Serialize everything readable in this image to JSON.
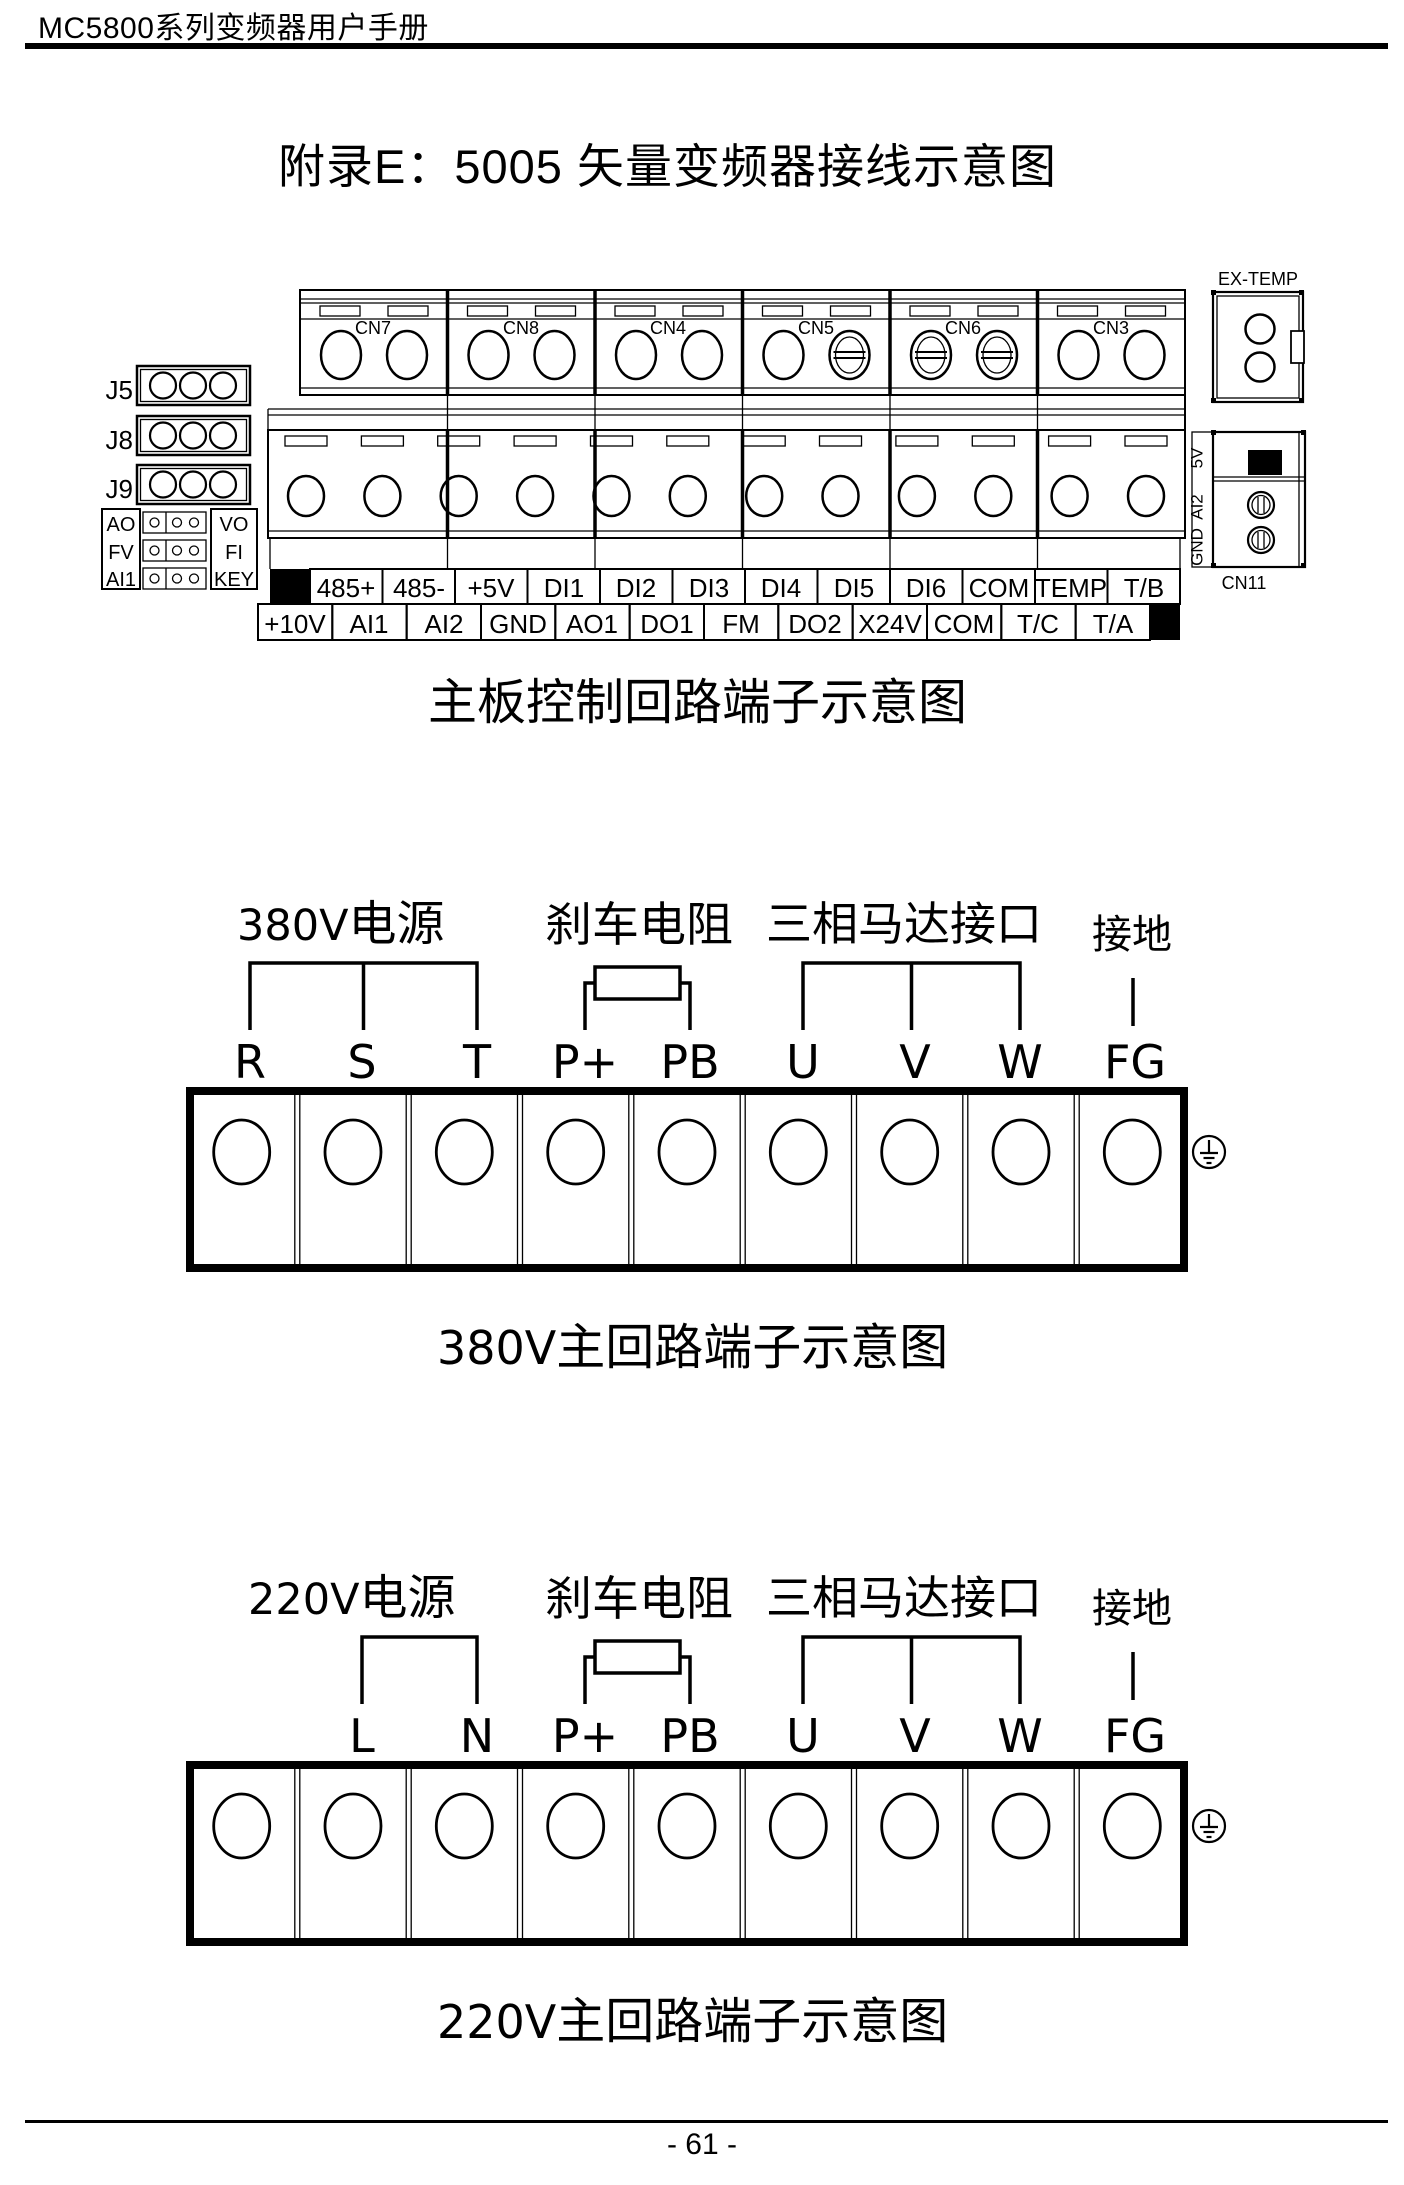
{
  "page": {
    "header": "MC5800系列变频器用户手册",
    "title": "附录E：5005 矢量变频器接线示意图",
    "footer": "- 61 -"
  },
  "board": {
    "caption": "主板控制回路端子示意图",
    "connectors": [
      "CN7",
      "CN8",
      "CN4",
      "CN5",
      "CN6",
      "CN3"
    ],
    "ex_temp": "EX-TEMP",
    "cn11": "CN11",
    "cn11_pins": [
      "5V",
      "AI2",
      "GND"
    ],
    "jumpers": [
      "J5",
      "J8",
      "J9"
    ],
    "jumper_left": [
      "AO",
      "FV",
      "AI1"
    ],
    "jumper_right": [
      "VO",
      "FI",
      "KEY"
    ],
    "row1": [
      "485+",
      "485-",
      "+5V",
      "DI1",
      "DI2",
      "DI3",
      "DI4",
      "DI5",
      "DI6",
      "COM",
      "TEMP",
      "T/B"
    ],
    "row2": [
      "+10V",
      "AI1",
      "AI2",
      "GND",
      "AO1",
      "DO1",
      "FM",
      "DO2",
      "X24V",
      "COM",
      "T/C",
      "T/A"
    ]
  },
  "s380": {
    "power_prefix": "380V",
    "power_suffix": "电源",
    "brake": "刹车电阻",
    "motor": "三相马达接口",
    "ground": "接地",
    "terminals": [
      "R",
      "S",
      "T",
      "P+",
      "PB",
      "U",
      "V",
      "W",
      "FG"
    ],
    "caption_prefix": "380V",
    "caption_suffix": "主回路端子示意图"
  },
  "s220": {
    "power_prefix": "220V",
    "power_suffix": "电源",
    "brake": "刹车电阻",
    "motor": "三相马达接口",
    "ground": "接地",
    "terminals": [
      "L",
      "N",
      "P+",
      "PB",
      "U",
      "V",
      "W",
      "FG"
    ],
    "caption_prefix": "220V",
    "caption_suffix": "主回路端子示意图"
  }
}
